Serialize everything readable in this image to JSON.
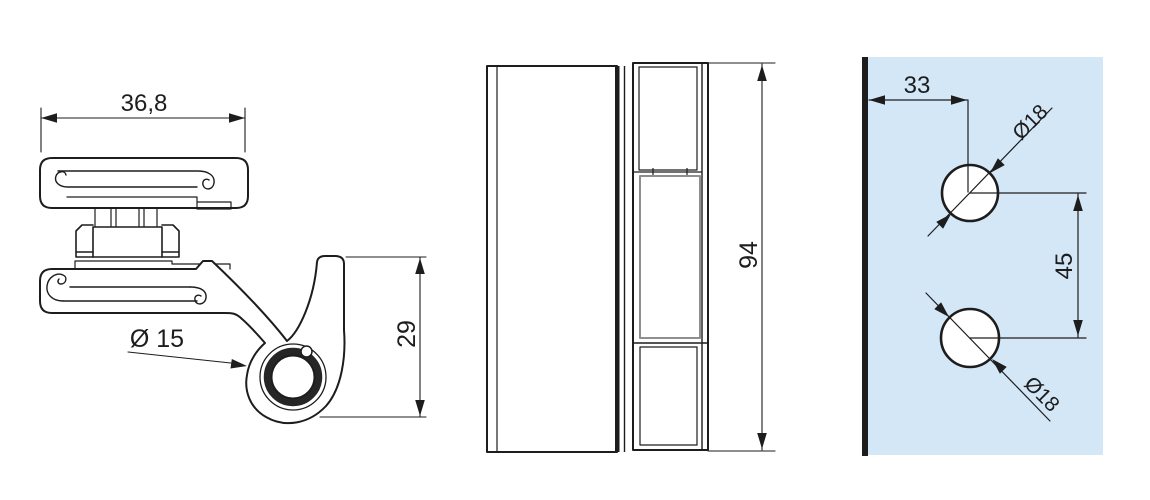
{
  "colors": {
    "line": "#1d1d1d",
    "grey_line": "#8f8f8f",
    "panel_fill": "#d4e7f7",
    "background": "#ffffff"
  },
  "front_view": {
    "description": "hinge profile cross-section",
    "width_dim": "36,8",
    "bore_dim": "Ø 15",
    "height_dim": "29"
  },
  "side_view": {
    "description": "hinge side elevation",
    "height_dim": "94"
  },
  "mounting_view": {
    "description": "glass panel drilling template",
    "edge_offset_dim": "33",
    "top_hole_dim": "Ø18",
    "hole_spacing_dim": "45",
    "bottom_hole_dim": "Ø18"
  }
}
